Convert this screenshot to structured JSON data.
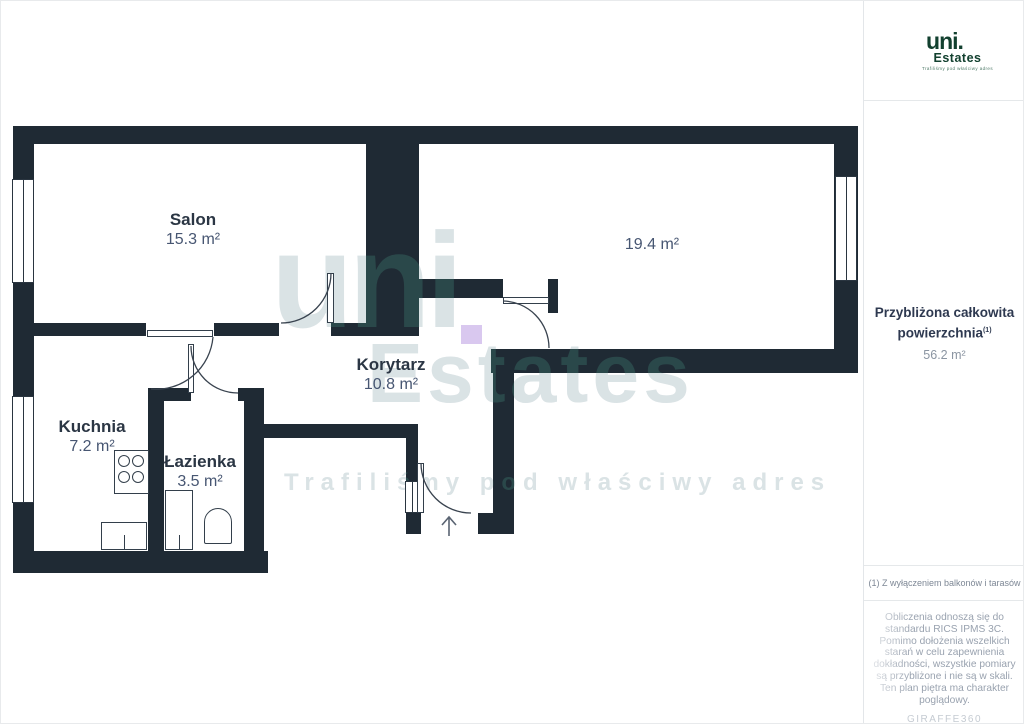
{
  "plan": {
    "rooms": [
      {
        "name": "Salon",
        "area": "15.3 m²"
      },
      {
        "name": "",
        "area": "19.4 m²"
      },
      {
        "name": "Kuchnia",
        "area": "7.2 m²"
      },
      {
        "name": "Łazienka",
        "area": "3.5 m²"
      },
      {
        "name": "Korytarz",
        "area": "10.8 m²"
      }
    ],
    "watermark": {
      "word1": "uni",
      "word2": "Estates",
      "tagline": "Trafiliśmy pod właściwy adres"
    }
  },
  "sidebar": {
    "logo": {
      "name": "uni.",
      "sub": "Estates",
      "tagline": "Trafiliśmy pod właściwy adres"
    },
    "total_area_label_line1": "Przybliżona całkowita",
    "total_area_label_line2": "powierzchnia",
    "total_area_sup": "(1)",
    "total_area_value": "56.2 m²",
    "footnote": "(1) Z wyłączeniem balkonów i tarasów",
    "disclaimer": "Obliczenia odnoszą się do standardu RICS IPMS 3C. Pomimo dołożenia wszelkich starań w celu zapewnienia dokładności, wszystkie pomiary są przybliżone i nie są w skali. Ten plan piętra ma charakter poglądowy.",
    "brand": "GIRAFFE360"
  },
  "colors": {
    "wall": "#1f2a34",
    "accent_green": "#12402f",
    "watermark_gray": "#d8dee2",
    "watermark_purple": "#d9c8ef",
    "label_navy": "#2b3644",
    "area_gray": "#475672"
  }
}
